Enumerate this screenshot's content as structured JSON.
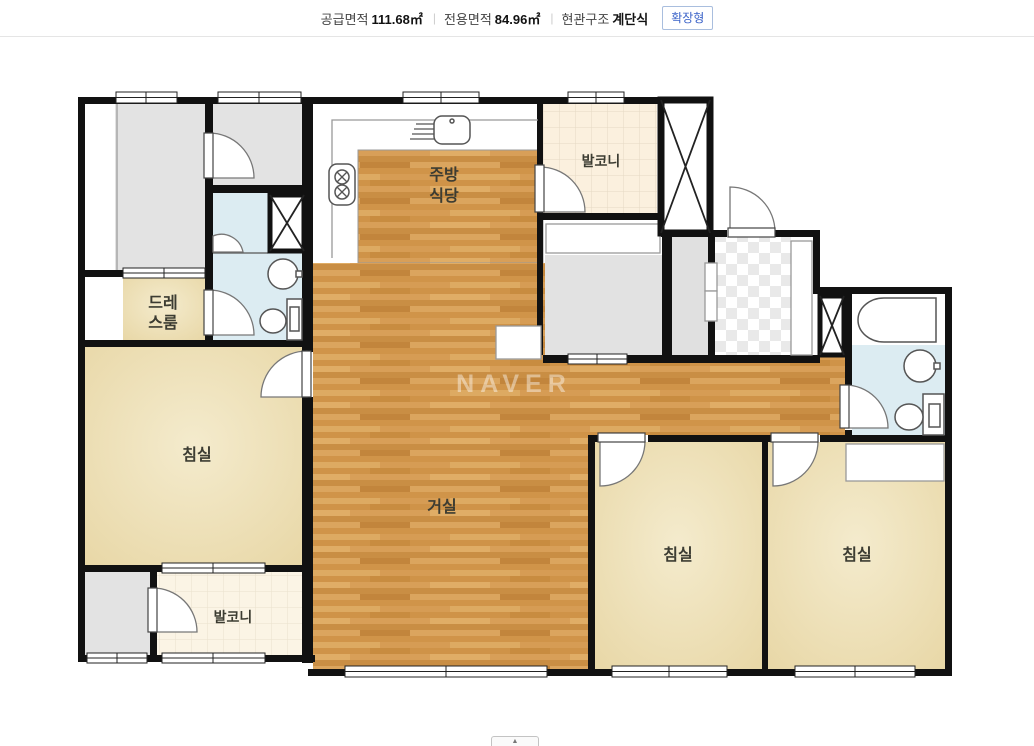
{
  "header": {
    "supply_area_label": "공급면적",
    "supply_area_value": "111.68㎡",
    "separator": "|",
    "exclusive_area_label": "전용면적",
    "exclusive_area_value": "84.96㎡",
    "entrance_label": "현관구조",
    "entrance_value": "계단식",
    "expand_button": "확장형"
  },
  "floorplan": {
    "watermark": "NAVER",
    "labels": {
      "kitchen_line1": "주방",
      "kitchen_line2": "식당",
      "balcony_top": "발코니",
      "balcony_bottom": "발코니",
      "dress_line1": "드레",
      "dress_line2": "스룸",
      "bedroom_left": "침실",
      "bedroom_mid": "침실",
      "bedroom_right": "침실",
      "living": "거실"
    },
    "colors": {
      "wall": "#111111",
      "wood_floor": "#d29952",
      "bedroom_beige": "#ecdfb3",
      "bathroom_blue": "#dcecf2",
      "balcony_tile": "#fbf0de",
      "room_gray": "#e3e3e3",
      "accent_blue": "#3a62c8"
    }
  },
  "footer": {
    "collapse_button": "▲"
  }
}
